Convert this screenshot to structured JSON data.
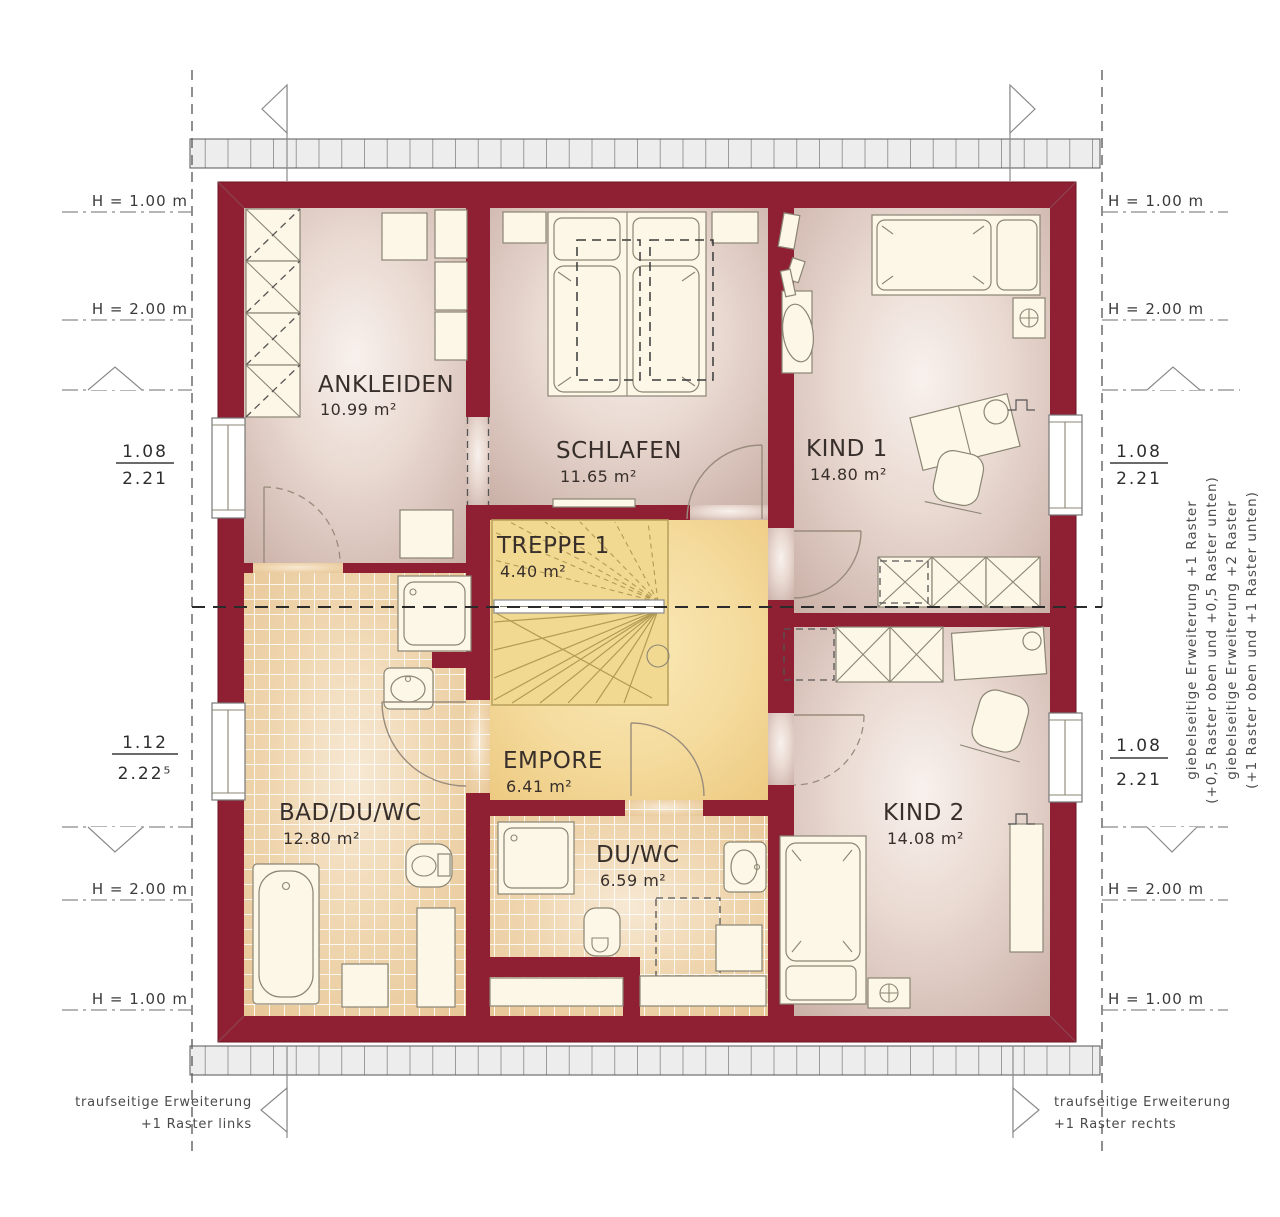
{
  "rooms": {
    "ankleiden": {
      "name": "ANKLEIDEN",
      "area": "10.99 m²"
    },
    "schlafen": {
      "name": "SCHLAFEN",
      "area": "11.65 m²"
    },
    "kind1": {
      "name": "KIND 1",
      "area": "14.80 m²"
    },
    "treppe": {
      "name": "TREPPE 1",
      "area": "4.40 m²"
    },
    "empore": {
      "name": "EMPORE",
      "area": "6.41 m²"
    },
    "bad": {
      "name": "BAD/DU/WC",
      "area": "12.80 m²"
    },
    "duwc": {
      "name": "DU/WC",
      "area": "6.59 m²"
    },
    "kind2": {
      "name": "KIND 2",
      "area": "14.08 m²"
    }
  },
  "heights": {
    "h100": "H = 1.00 m",
    "h200": "H = 2.00 m"
  },
  "dimensions": {
    "left_top": {
      "num": "1.08",
      "den": "2.21"
    },
    "left_bottom": {
      "num": "1.12",
      "den": "2.22⁵"
    },
    "right_top": {
      "num": "1.08",
      "den": "2.21"
    },
    "right_bottom": {
      "num": "1.08",
      "den": "2.21"
    }
  },
  "annotations": {
    "gable_right": {
      "line1": "giebelseitige Erweiterung +1 Raster",
      "line2": "(+0,5 Raster oben und +0,5 Raster unten)",
      "line3": "giebelseitige Erweiterung +2 Raster",
      "line4": "(+1 Raster oben und +1 Raster unten)"
    },
    "eave_left": {
      "line1": "traufseitige Erweiterung",
      "line2": "+1 Raster links"
    },
    "eave_right": {
      "line1": "traufseitige Erweiterung",
      "line2": "+1 Raster rechts"
    }
  },
  "colors": {
    "wall": "#8f2034",
    "stair_accent": "#b49b55",
    "tile": "#e6c493",
    "floor": "#d3bcb3",
    "landing": "#f4da9c",
    "roof_band": "#ededed"
  }
}
